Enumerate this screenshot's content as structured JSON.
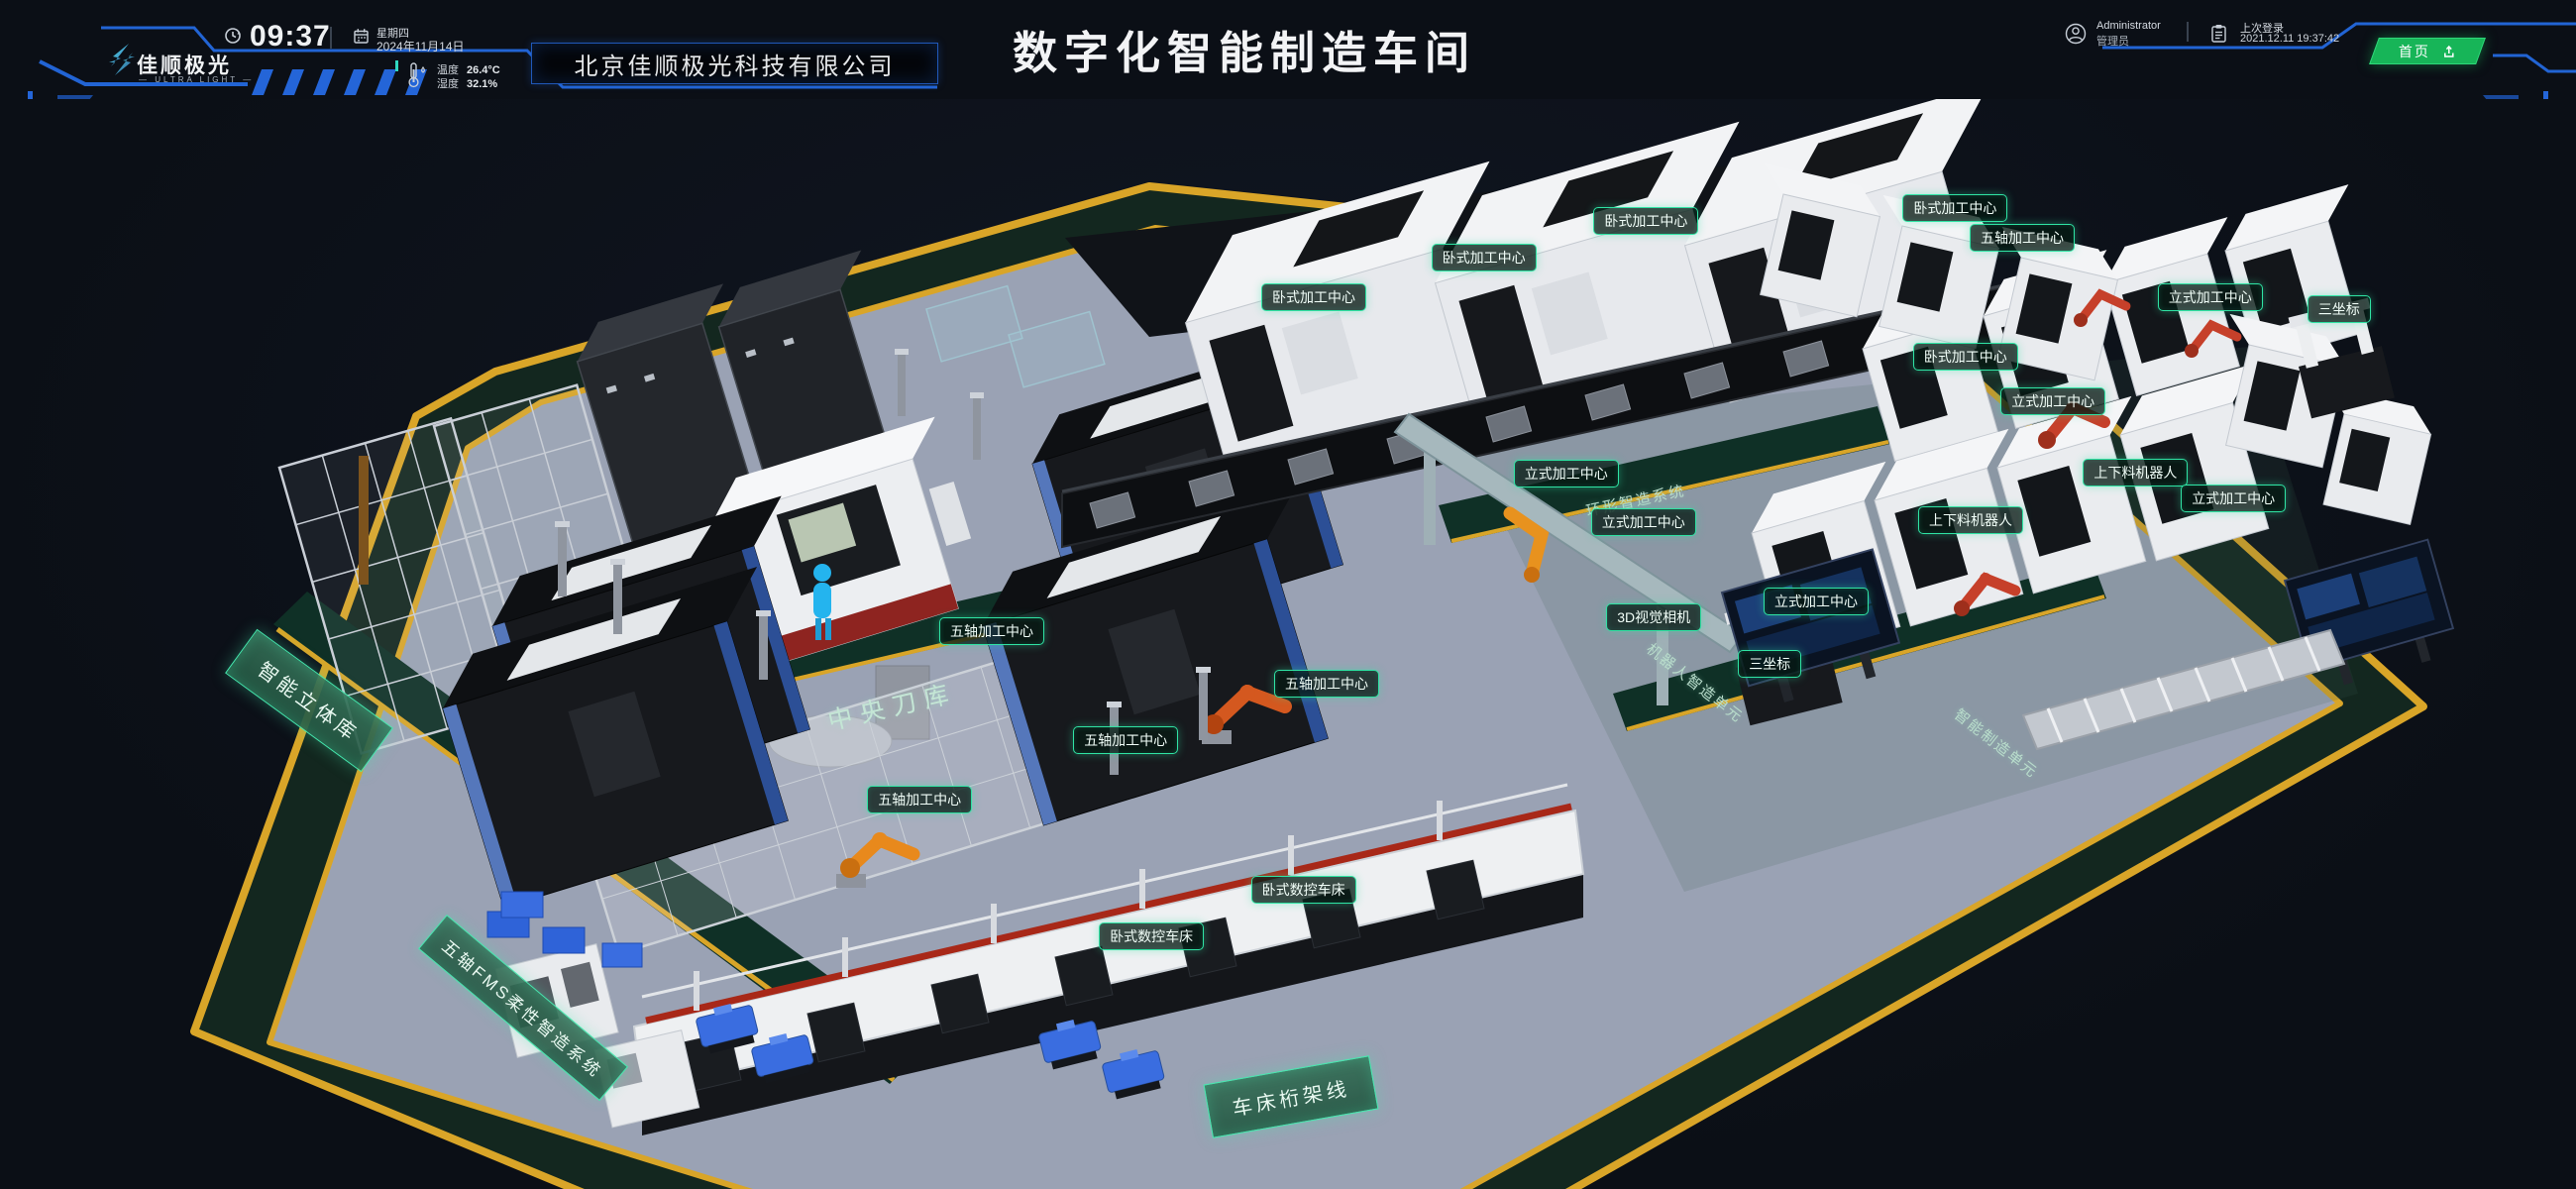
{
  "header": {
    "logo": {
      "name": "佳顺极光",
      "subtitle": "— ULTRA LIGHT —"
    },
    "clock": {
      "time": "09:37",
      "weekday": "星期四",
      "date": "2024年11月14日"
    },
    "weather": {
      "temp_label": "温度",
      "temp_value": "26.4°C",
      "humidity_label": "湿度",
      "humidity_value": "32.1%"
    },
    "company": "北京佳顺极光科技有限公司",
    "title": "数字化智能制造车间",
    "user": {
      "name": "Administrator",
      "role": "管理员"
    },
    "last_login": {
      "label": "上次登录",
      "value": "2021.12.11 19:37:42"
    },
    "home_button": "首页"
  },
  "scene": {
    "area_signs": [
      {
        "type": "panel",
        "text": "智能立体库",
        "x": 12.0,
        "y": 55.2,
        "rot": 36
      },
      {
        "type": "panel-lg",
        "text": "五轴FMS柔性智造系统",
        "x": 20.3,
        "y": 83.4,
        "rot": 40
      },
      {
        "type": "panel",
        "text": "车床桁架线",
        "x": 50.1,
        "y": 91.5,
        "rot": -10
      },
      {
        "type": "wall",
        "text": "中央刀库",
        "x": 34.6,
        "y": 55.6,
        "rot": -13
      },
      {
        "type": "wall-sm",
        "text": "环形智造系统",
        "x": 63.5,
        "y": 36.8,
        "rot": -12
      },
      {
        "type": "wall-sm",
        "text": "机器人智造单元",
        "x": 65.8,
        "y": 53.5,
        "rot": 38
      },
      {
        "type": "wall-sm",
        "text": "智能制造单元",
        "x": 77.5,
        "y": 59.1,
        "rot": 38
      }
    ],
    "machine_labels": [
      {
        "text": "五轴加工中心",
        "x": 38.5,
        "y": 48.8
      },
      {
        "text": "五轴加工中心",
        "x": 35.7,
        "y": 64.3
      },
      {
        "text": "五轴加工中心",
        "x": 43.7,
        "y": 58.8
      },
      {
        "text": "五轴加工中心",
        "x": 51.5,
        "y": 53.6
      },
      {
        "text": "卧式加工中心",
        "x": 51.0,
        "y": 18.2
      },
      {
        "text": "卧式加工中心",
        "x": 57.6,
        "y": 14.5
      },
      {
        "text": "卧式加工中心",
        "x": 63.9,
        "y": 11.2
      },
      {
        "text": "立式加工中心",
        "x": 60.8,
        "y": 34.4
      },
      {
        "text": "立式加工中心",
        "x": 63.8,
        "y": 38.8
      },
      {
        "text": "3D视觉相机",
        "x": 64.2,
        "y": 47.5
      },
      {
        "text": "立式加工中心",
        "x": 70.5,
        "y": 46.1
      },
      {
        "text": "三坐标",
        "x": 68.7,
        "y": 51.8
      },
      {
        "text": "卧式加工中心",
        "x": 76.3,
        "y": 23.6
      },
      {
        "text": "立式加工中心",
        "x": 79.7,
        "y": 27.7
      },
      {
        "text": "上下料机器人",
        "x": 82.9,
        "y": 34.3
      },
      {
        "text": "立式加工中心",
        "x": 86.7,
        "y": 36.6
      },
      {
        "text": "上下料机器人",
        "x": 76.5,
        "y": 38.6
      },
      {
        "text": "卧式数控车床",
        "x": 50.6,
        "y": 72.5
      },
      {
        "text": "卧式数控车床",
        "x": 44.7,
        "y": 76.8
      },
      {
        "text": "立式加工中心",
        "x": 85.8,
        "y": 18.2
      },
      {
        "text": "三坐标",
        "x": 90.8,
        "y": 19.3
      },
      {
        "text": "卧式加工中心",
        "x": 75.9,
        "y": 10.0
      },
      {
        "text": "五轴加工中心",
        "x": 78.5,
        "y": 12.7
      }
    ]
  },
  "colors": {
    "accent_blue": "#2264d4",
    "accent_teal": "#2fe3a4",
    "accent_green": "#17b558",
    "background": "#0b0f16",
    "platform_edge_yellow": "#d9a528",
    "walkway_green": "#0f3026",
    "floor_gray": "#9aa2b4"
  }
}
